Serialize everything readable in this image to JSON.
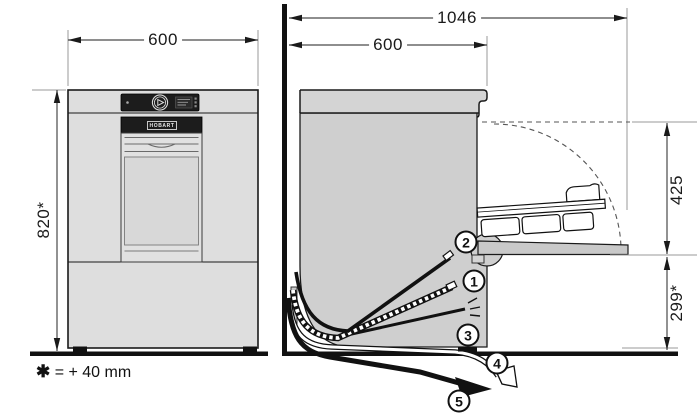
{
  "title": "Undercounter dishwasher installation drawing",
  "front_view": {
    "width_dim": "600",
    "height_dim": "820*",
    "brand": "HOBART"
  },
  "side_view": {
    "total_depth_dim": "1046",
    "body_depth_dim": "600",
    "rack_clearance_dim": "425",
    "hose_level_dim": "299*",
    "callouts": [
      "1",
      "2",
      "3",
      "4",
      "5"
    ]
  },
  "note": {
    "star": "✱",
    "text": "= + 40 mm"
  },
  "colors": {
    "line": "#1a1a1a",
    "body_front": "#dedede",
    "body_side": "#cfcfcf",
    "panel_dark": "#1c1c1c",
    "wall_floor": "#111111"
  }
}
